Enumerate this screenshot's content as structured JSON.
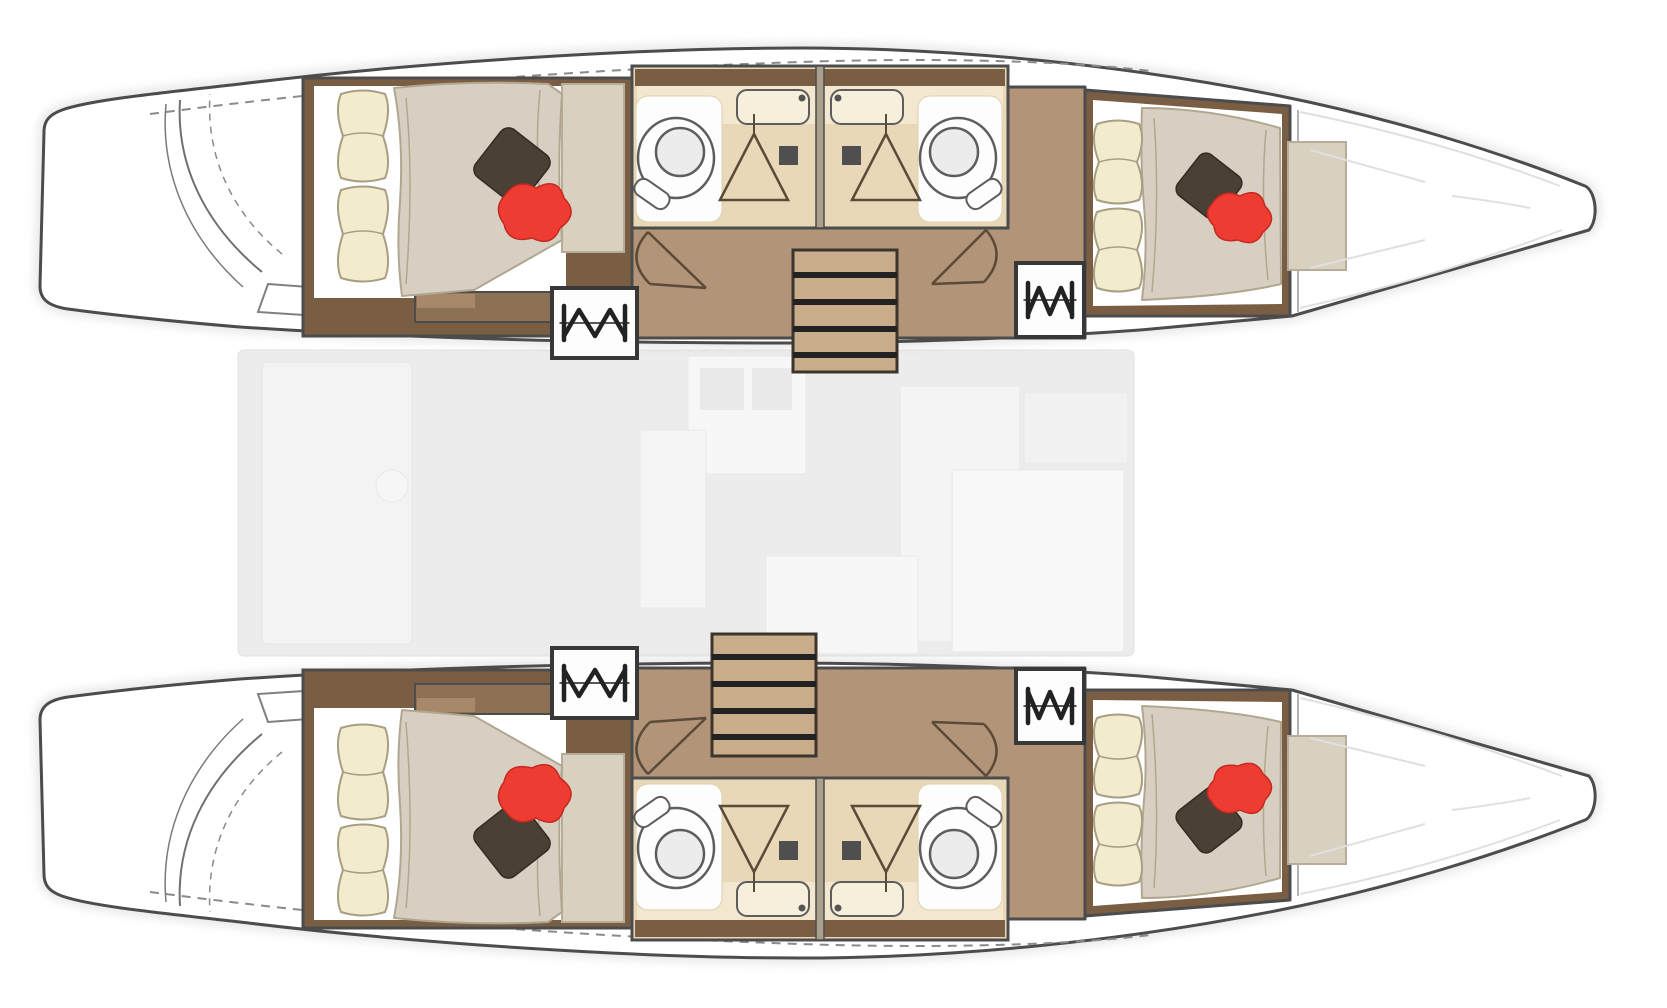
{
  "palette": {
    "bg": "#ffffff",
    "outline": "#4c4c4c",
    "line-soft": "#8a8a8a",
    "hull-fill": "#ffffff",
    "hull-shadow": "#d2d2d2",
    "wood-dark": "#7a5e44",
    "wood-mid": "#b29478",
    "wood-light": "#c9ad8a",
    "step-wood": "#8d7154",
    "bath-floor": "#e9d8b7",
    "bath-counter": "#f3e8cf",
    "divider": "#a89f8d",
    "fixture": "#fdfdfd",
    "fixture-stroke": "#5d5d5d",
    "duvet": "#d7cfc1",
    "duvet-stroke": "#b1a791",
    "pillow-cream": "#f2ebcd",
    "pillow-stroke": "#a89e81",
    "pillow-red": "#ee3c32",
    "pillow-red-deep": "#c5291f",
    "pillow-dark": "#4b4036",
    "panel": "#d9d1bf",
    "panel-stroke": "#b6ac99",
    "saloon": "#ececec",
    "saloon-soft": "#f5f5f5",
    "hatch-ink": "#222222",
    "door-stroke": "#5a4a38"
  },
  "vessel": {
    "type": "catamaran",
    "view": "top-down floor plan",
    "orientation": {
      "bow": "right",
      "stern": "left"
    },
    "cabins": 4,
    "heads": 4,
    "companionway_stairs": 2,
    "engine_hatches": 4,
    "hulls": [
      {
        "id": "port-hull",
        "position": "top",
        "rooms": [
          "aft-double-cabin",
          "twin-head-compartments",
          "companionway-corridor",
          "forward-double-cabin",
          "forepeak-locker"
        ]
      },
      {
        "id": "starboard-hull",
        "position": "bottom",
        "rooms": [
          "aft-double-cabin",
          "twin-head-compartments",
          "companionway-corridor",
          "forward-double-cabin",
          "forepeak-locker"
        ]
      }
    ],
    "head_fixtures": [
      "toilet",
      "vanity-sink",
      "shower-tray",
      "drain"
    ],
    "bed_decor": [
      "cream-bolster-pillows",
      "beige-duvet",
      "dark-diamond-cushion",
      "red-accent-cushion"
    ],
    "bridgedeck": {
      "render_state": "faded-overlay",
      "furniture_hints": [
        "galley-block",
        "cockpit-bench",
        "dinette",
        "saloon-table",
        "aft-bench",
        "helm-seat",
        "side-unit"
      ]
    }
  }
}
